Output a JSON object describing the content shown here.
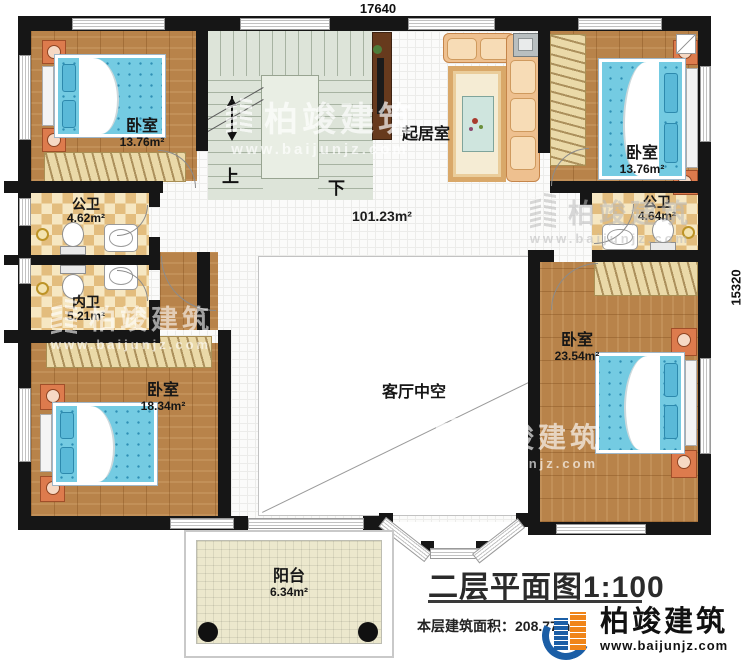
{
  "plan": {
    "dimensions": {
      "top": "17640",
      "right": "15320"
    },
    "stairs": {
      "up": "上",
      "down": "下"
    },
    "hall": {
      "area": "101.23m²"
    },
    "rooms": {
      "bedroom_top_left": {
        "name": "卧室",
        "area": "13.76m²"
      },
      "bedroom_top_right": {
        "name": "卧室",
        "area": "13.76m²"
      },
      "bedroom_bottom_left": {
        "name": "卧室",
        "area": "18.34m²"
      },
      "bedroom_right": {
        "name": "卧室",
        "area": "23.54m²"
      },
      "living_room": {
        "name": "起居室"
      },
      "bath_public_left": {
        "name": "公卫",
        "area": "4.62m²"
      },
      "bath_inner": {
        "name": "内卫",
        "area": "5.21m²"
      },
      "bath_public_right": {
        "name": "公卫",
        "area": "4.64m²"
      },
      "void": {
        "name": "客厅中空"
      },
      "balcony": {
        "name": "阳台",
        "area": "6.34m²"
      }
    },
    "titleblock": {
      "title": "二层平面图1:100",
      "area_label": "本层建筑面积：",
      "area_value": "208.77m²"
    },
    "branding": {
      "company": "柏竣建筑",
      "website": "www.baijunjz.com"
    },
    "watermark": {
      "company": "柏竣建筑",
      "website": "www.baijunjz.com"
    },
    "colors": {
      "wall": "#161616",
      "wood_floor": "#b8834a",
      "bath_tile": "#e3bd7e",
      "mattress_blue": "#74cbe2",
      "logo_blue": "#1b5ea6",
      "logo_orange": "#f08519"
    }
  }
}
